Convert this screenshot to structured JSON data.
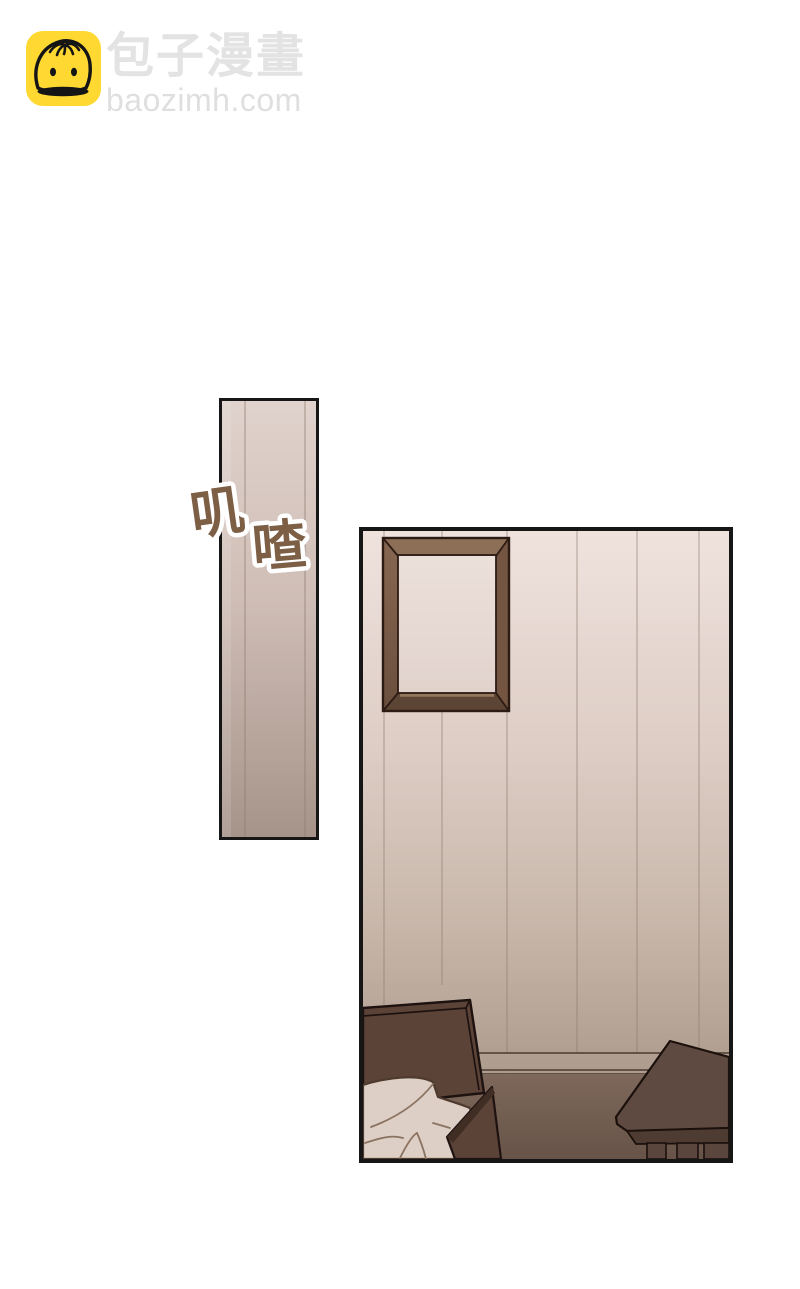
{
  "watermark": {
    "site_name": "包子漫畫",
    "site_domain": "baozimh.com",
    "badge_color": "#ffd932",
    "text_color": "#e3e3e3"
  },
  "sfx": {
    "char_1": "叽",
    "char_2": "喳",
    "text_color": "#7c5f45",
    "outline_color": "#ffffff"
  },
  "scene": {
    "panel_count": 2,
    "panel_border_color": "#161616",
    "palette": {
      "wall_light": "#efe2dd",
      "wall_mid": "#cfbeb4",
      "wall_dark": "#a8968a",
      "baseboard_line": "#4a3a30",
      "floor_light": "#7e685b",
      "floor_dark": "#675348",
      "wood_dark": "#5b4338",
      "wood_shadow": "#402e25",
      "table_top": "#5e4a40",
      "table_apron": "#4e3b32",
      "bedding": "#ddcfc6",
      "frame_wood": "#8d6f58",
      "frame_inner": "#e9dbd6",
      "outline": "#1e1210"
    }
  }
}
